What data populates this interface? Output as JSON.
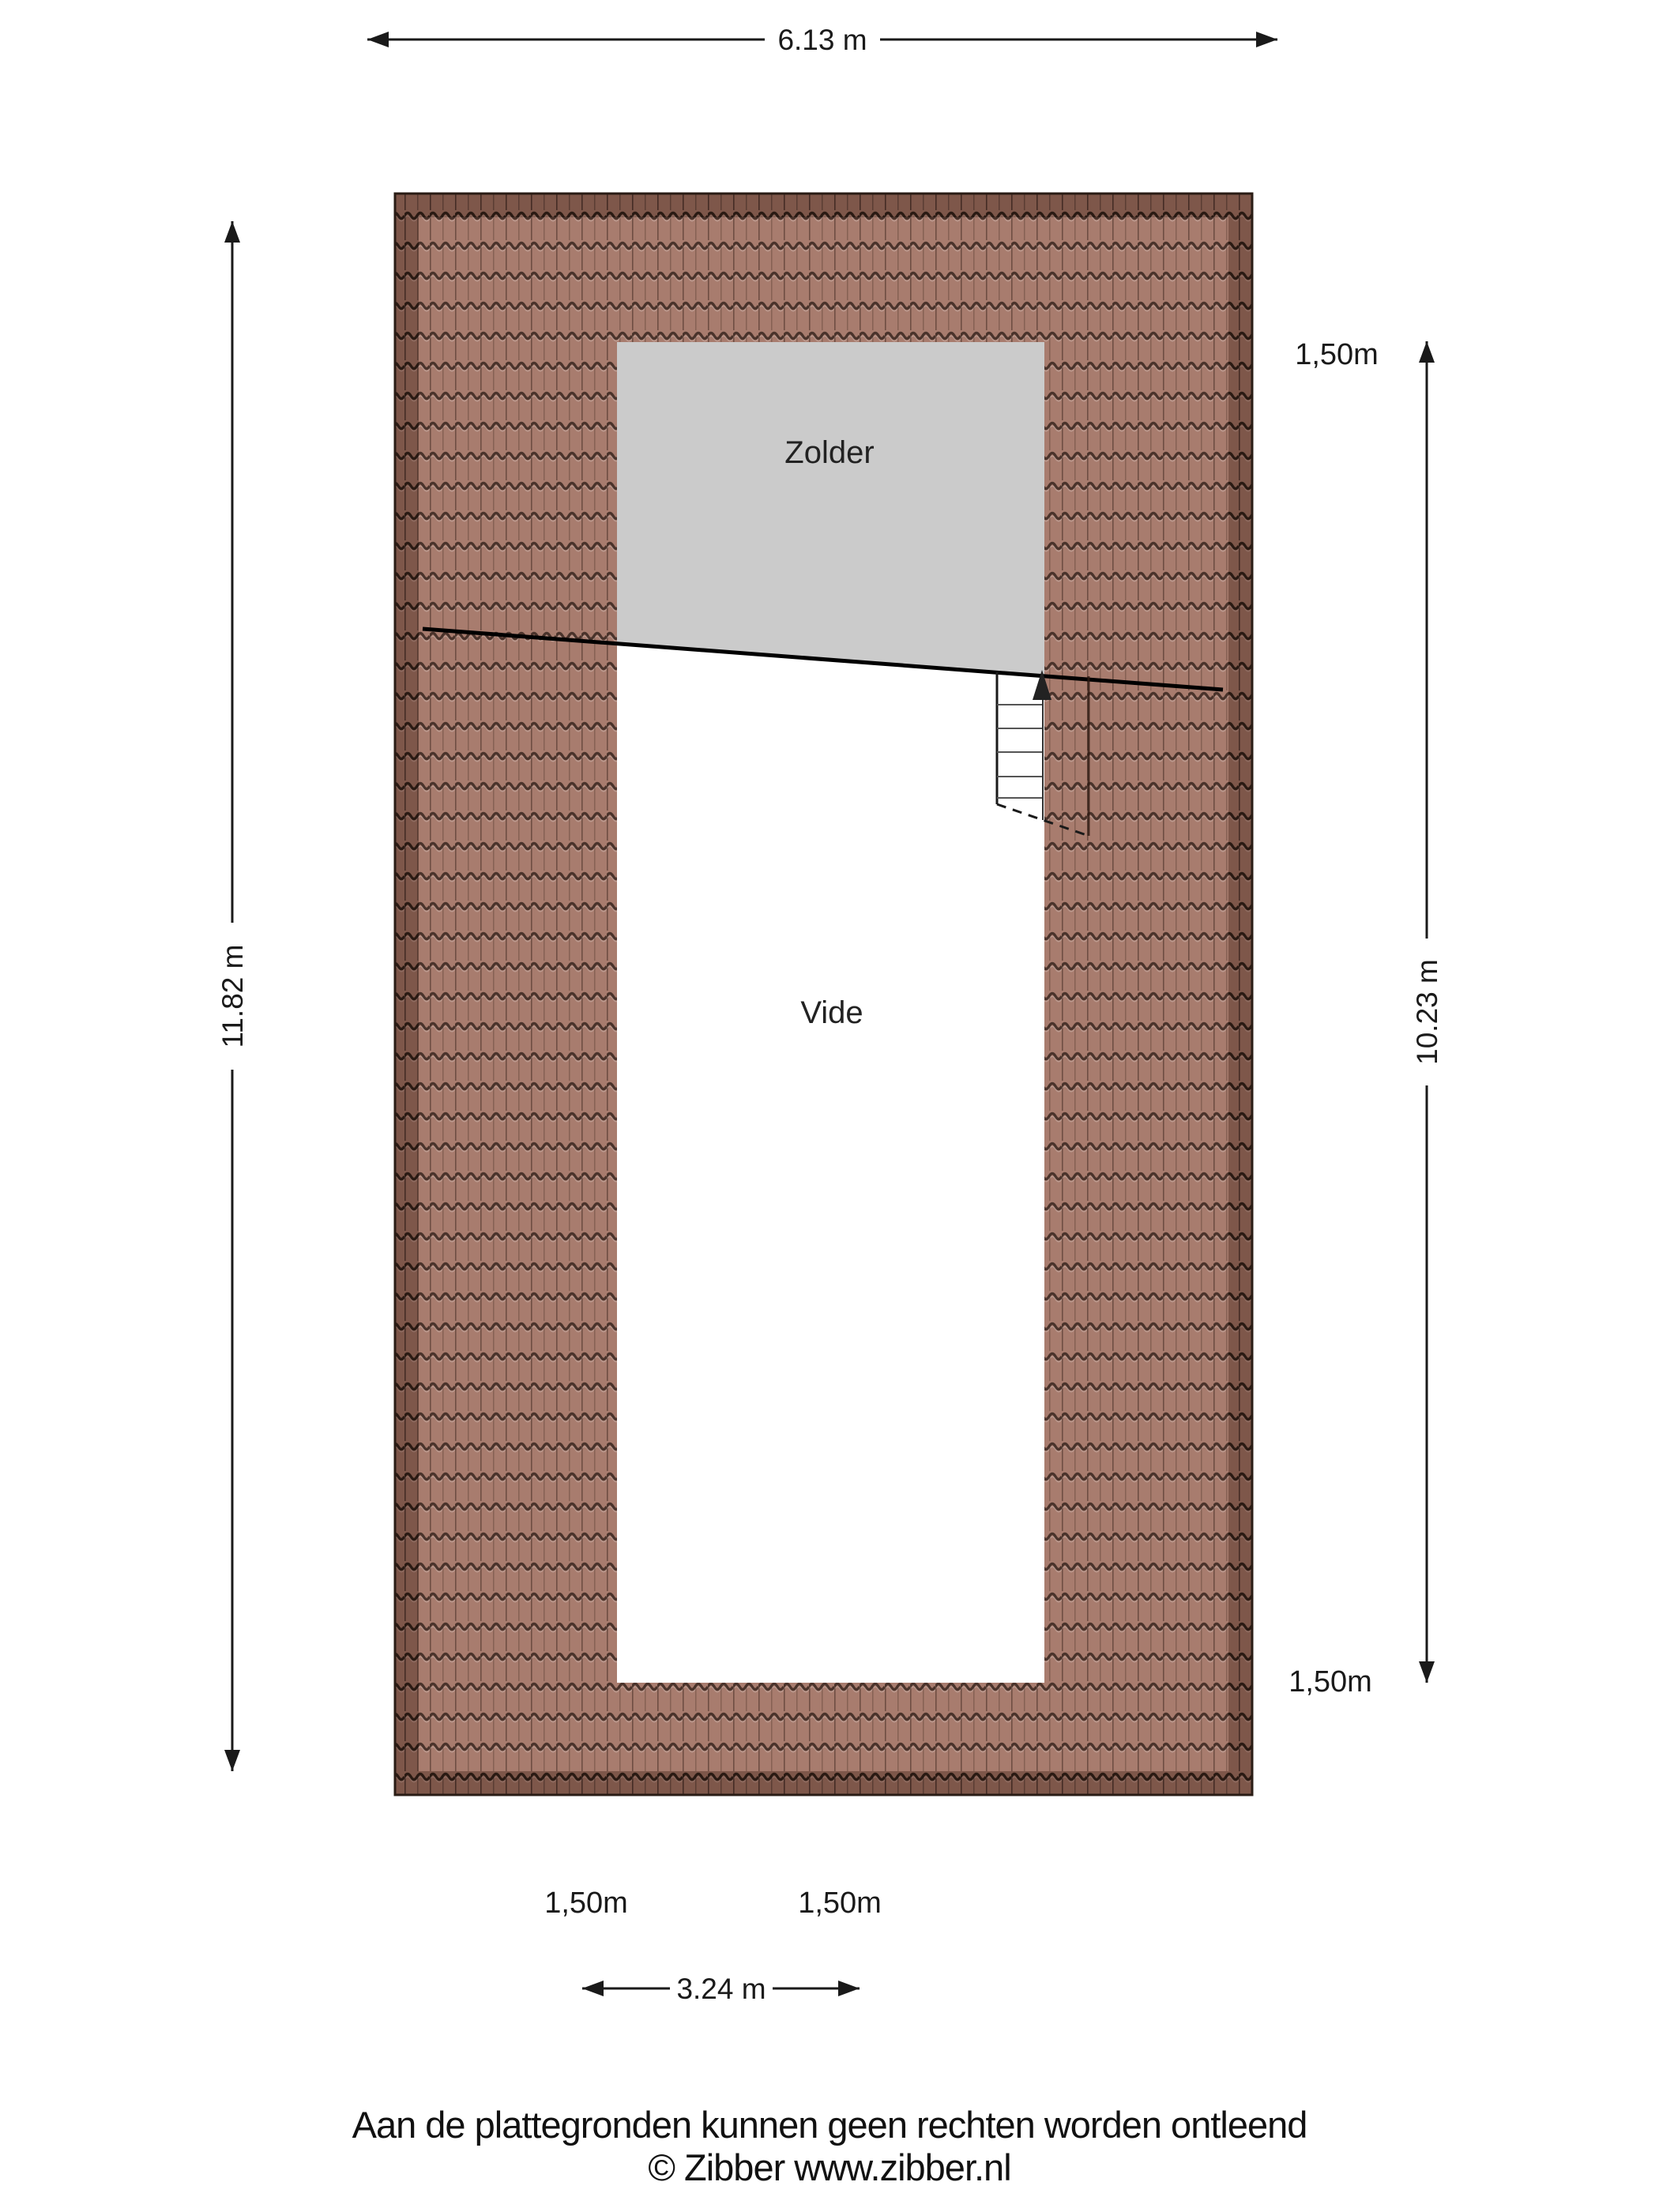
{
  "floorplan": {
    "rooms": [
      {
        "label": "Zolder"
      },
      {
        "label": "Vide"
      }
    ],
    "dimensions": {
      "top": "6.13 m",
      "left": "11.82 m",
      "right": "10.23 m",
      "bottom": "3.24 m"
    },
    "height_markers": [
      {
        "label": "1,50m",
        "position": "top-right"
      },
      {
        "label": "1,50m",
        "position": "bottom-right"
      },
      {
        "label": "1,50m",
        "position": "below-plan-left"
      },
      {
        "label": "1,50m",
        "position": "below-plan-right"
      }
    ],
    "colors": {
      "roof_tile": "#a87c6e",
      "roof_tile_border": "#7e574a",
      "zolder_fill": "#cbcbcb",
      "vide_fill": "#ffffff",
      "line": "#1a1a1a"
    },
    "footer": {
      "disclaimer": "Aan de plattegronden kunnen geen rechten worden ontleend",
      "copyright": "© Zibber www.zibber.nl"
    }
  }
}
